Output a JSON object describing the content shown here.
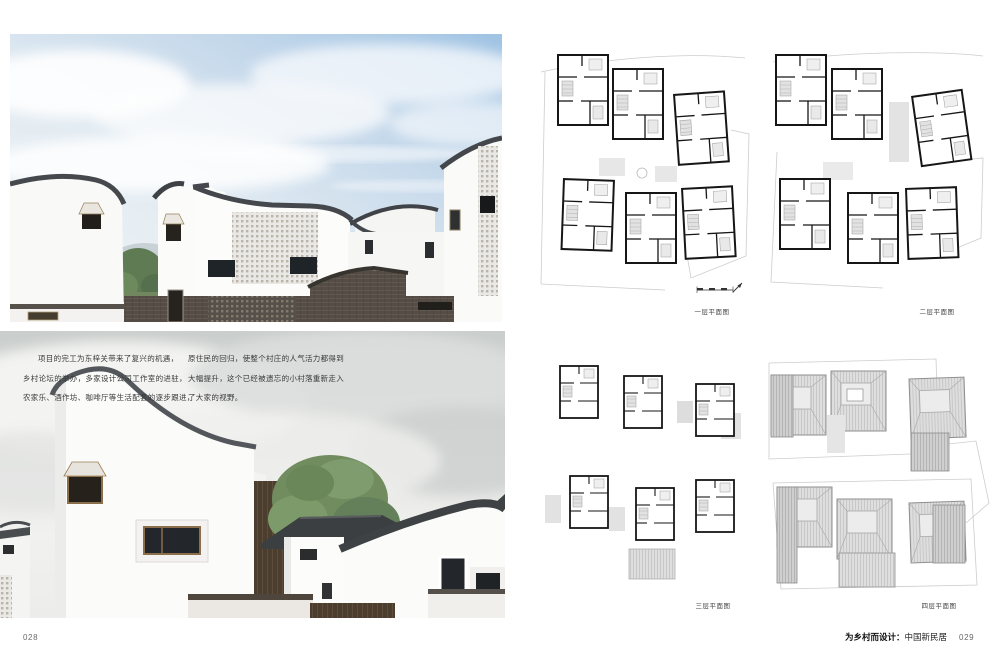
{
  "left_page": {
    "page_number": "028",
    "paragraph": {
      "column1_lines": [
        "项目的完工为东梓关带来了复兴的机遇，",
        "乡村论坛的举办，多家设计公司工作室的进驻，",
        "农家乐、酒作坊、咖啡厅等生活配套的逐步跟进，"
      ],
      "column2_lines": [
        "原住民的回归，使整个村庄的人气活力都得到",
        "大幅提升，这个已经被遗忘的小村落重新走入",
        "了大家的视野。"
      ]
    }
  },
  "right_page": {
    "plans": [
      {
        "caption": "一层平面图"
      },
      {
        "caption": "二层平面图"
      },
      {
        "caption": "三层平面图"
      },
      {
        "caption": "四层平面图"
      }
    ],
    "footer": {
      "series_title": "为乡村而设计：",
      "book_title": "中国新民居",
      "page_number": "029"
    }
  },
  "colors": {
    "page_background": "#ffffff",
    "body_text": "#3a3a3a",
    "caption_text": "#444444",
    "page_number_text": "#6b6b6b",
    "plan_wall": "#161616",
    "plan_light_fill": "#e2e2e2",
    "plan_site_line": "#cccccc",
    "roof_dark": "#46494d",
    "brick_dark": "#554d45",
    "sky_blue": "#9fc3e3",
    "tree_green": "#718c5f"
  }
}
